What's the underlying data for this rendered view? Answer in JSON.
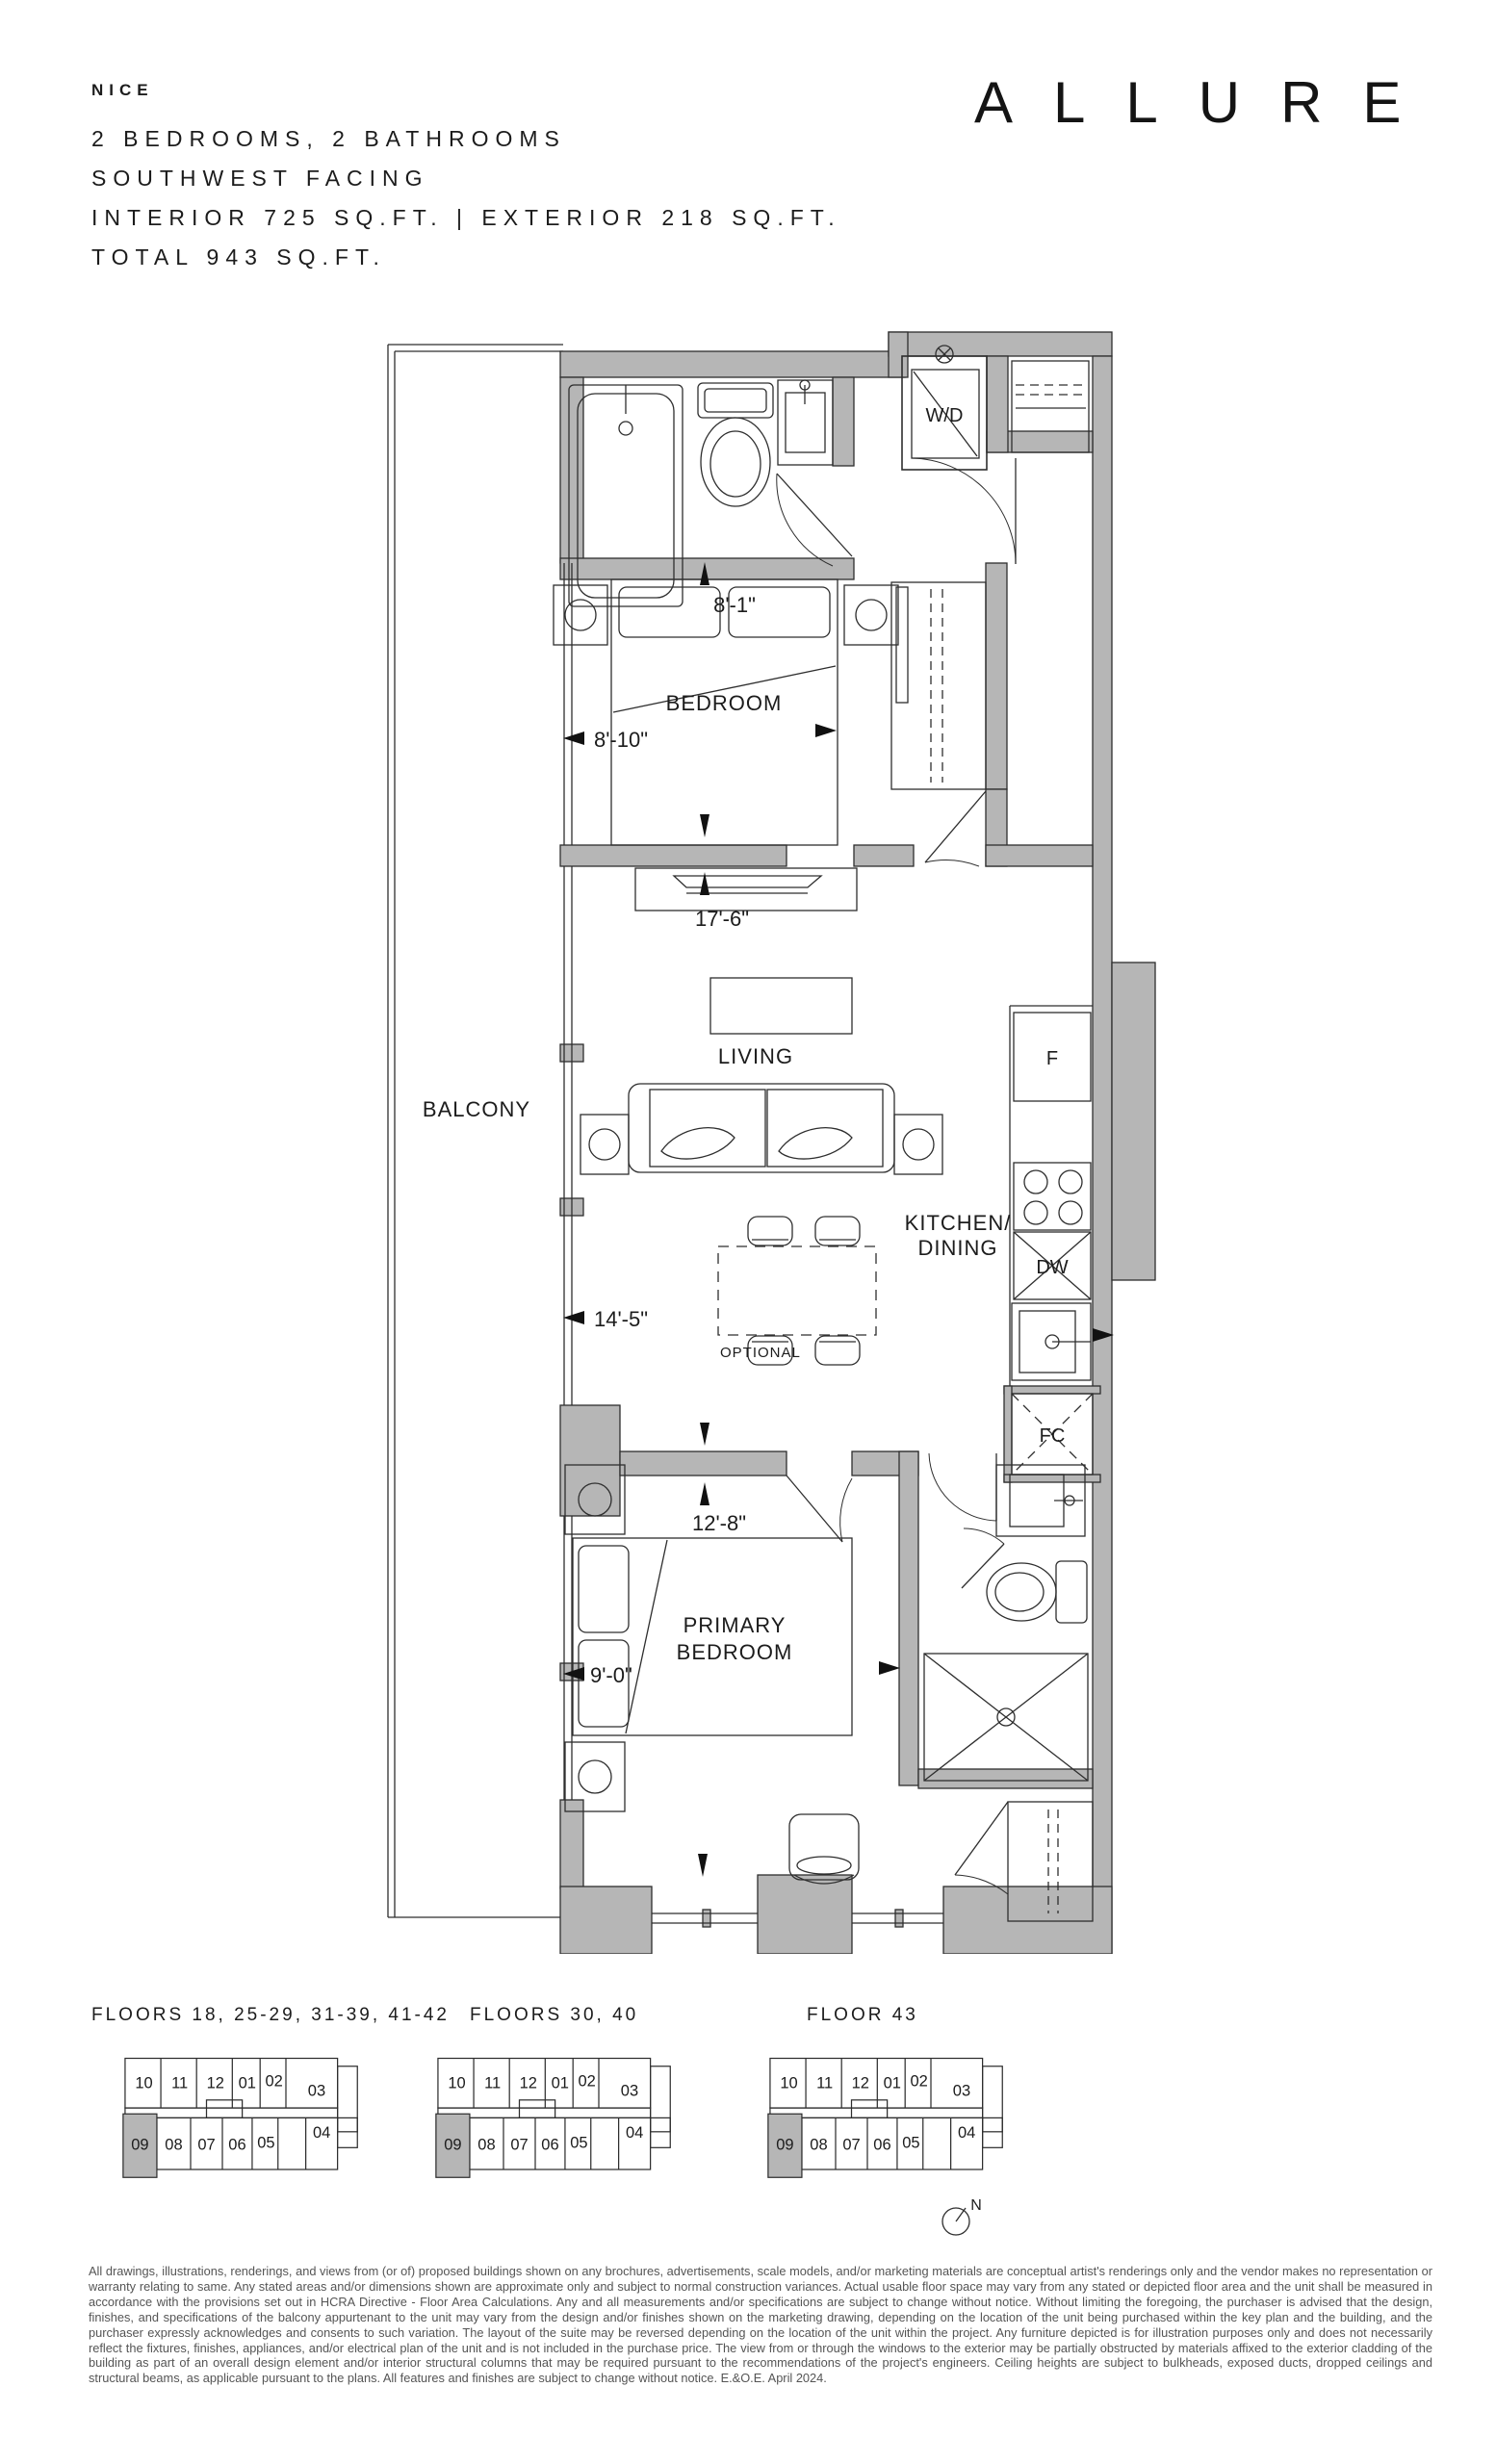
{
  "header": {
    "unit_name": "NICE",
    "line_bedrooms": "2 BEDROOMS, 2 BATHROOMS",
    "line_facing": "SOUTHWEST FACING",
    "line_area": "INTERIOR 725 SQ.FT. | EXTERIOR 218 SQ.FT.",
    "line_total": "TOTAL 943 SQ.FT."
  },
  "logo": {
    "brand": "ALLURE"
  },
  "floorplan": {
    "room_labels": {
      "balcony": "BALCONY",
      "bedroom": "BEDROOM",
      "living": "LIVING",
      "kitchen_line1": "KITCHEN/",
      "kitchen_line2": "DINING",
      "primary_line1": "PRIMARY",
      "primary_line2": "BEDROOM"
    },
    "fixture_labels": {
      "washer_dryer": "W/D",
      "fridge": "F",
      "dishwasher": "DW",
      "fan_coil": "FC"
    },
    "dimensions": {
      "bedroom_width": "8'-1\"",
      "bedroom_depth": "8'-10\"",
      "living_length": "17'-6\"",
      "dining_width": "14'-5\"",
      "primary_width": "12'-8\"",
      "primary_depth": "9'-0\""
    },
    "annotations": {
      "optional": "OPTIONAL"
    }
  },
  "keyplans": [
    {
      "title": "FLOORS 18, 25-29, 31-39, 41-42",
      "units_top": [
        "10",
        "11",
        "12",
        "01",
        "02",
        "03"
      ],
      "units_bottom": [
        "09",
        "08",
        "07",
        "06",
        "05",
        "04"
      ],
      "highlighted_unit": "09"
    },
    {
      "title": "FLOORS 30, 40",
      "units_top": [
        "10",
        "11",
        "12",
        "01",
        "02",
        "03"
      ],
      "units_bottom": [
        "09",
        "08",
        "07",
        "06",
        "05",
        "04"
      ],
      "highlighted_unit": "09"
    },
    {
      "title": "FLOOR 43",
      "units_top": [
        "10",
        "11",
        "12",
        "01",
        "02",
        "03"
      ],
      "units_bottom": [
        "09",
        "08",
        "07",
        "06",
        "05",
        "04"
      ],
      "highlighted_unit": "09",
      "compass_label": "N"
    }
  ],
  "disclaimer": "All drawings, illustrations, renderings, and views from (or of) proposed buildings shown on any brochures, advertisements, scale models, and/or marketing materials are conceptual artist's renderings only and the vendor makes no representation or warranty relating to same. Any stated areas and/or dimensions shown are approximate only and subject to normal construction variances. Actual usable floor space may vary from any stated or depicted floor area and the unit shall be measured in accordance with the provisions set out in HCRA Directive - Floor Area Calculations. Any and all measurements and/or specifications are subject to change without notice. Without limiting the foregoing, the purchaser is advised that the design, finishes, and specifications of the balcony appurtenant to the unit may vary from the design and/or finishes shown on the marketing drawing, depending on the location of the unit being purchased within the key plan and the building, and the purchaser expressly acknowledges and consents to such variation. The layout of the suite may be reversed depending on the location of the unit within the project. Any furniture depicted is for illustration purposes only and does not necessarily reflect the fixtures, finishes, appliances, and/or electrical plan of the unit and is not included in the purchase price. The view from or through the windows to the exterior may be partially obstructed by materials affixed to the exterior cladding of the building as part of an overall design element and/or interior structural columns that may be required pursuant to the recommendations of the project's engineers. Ceiling heights are subject to bulkheads, exposed ducts, dropped ceilings and structural beams, as applicable pursuant to the plans. All features and finishes are subject to change without notice. E.&O.E. April 2024.",
  "colors": {
    "wall_fill": "#b6b6b6",
    "line": "#2e2e2e",
    "text": "#1c1c1c",
    "disclaimer_text": "#555555"
  }
}
